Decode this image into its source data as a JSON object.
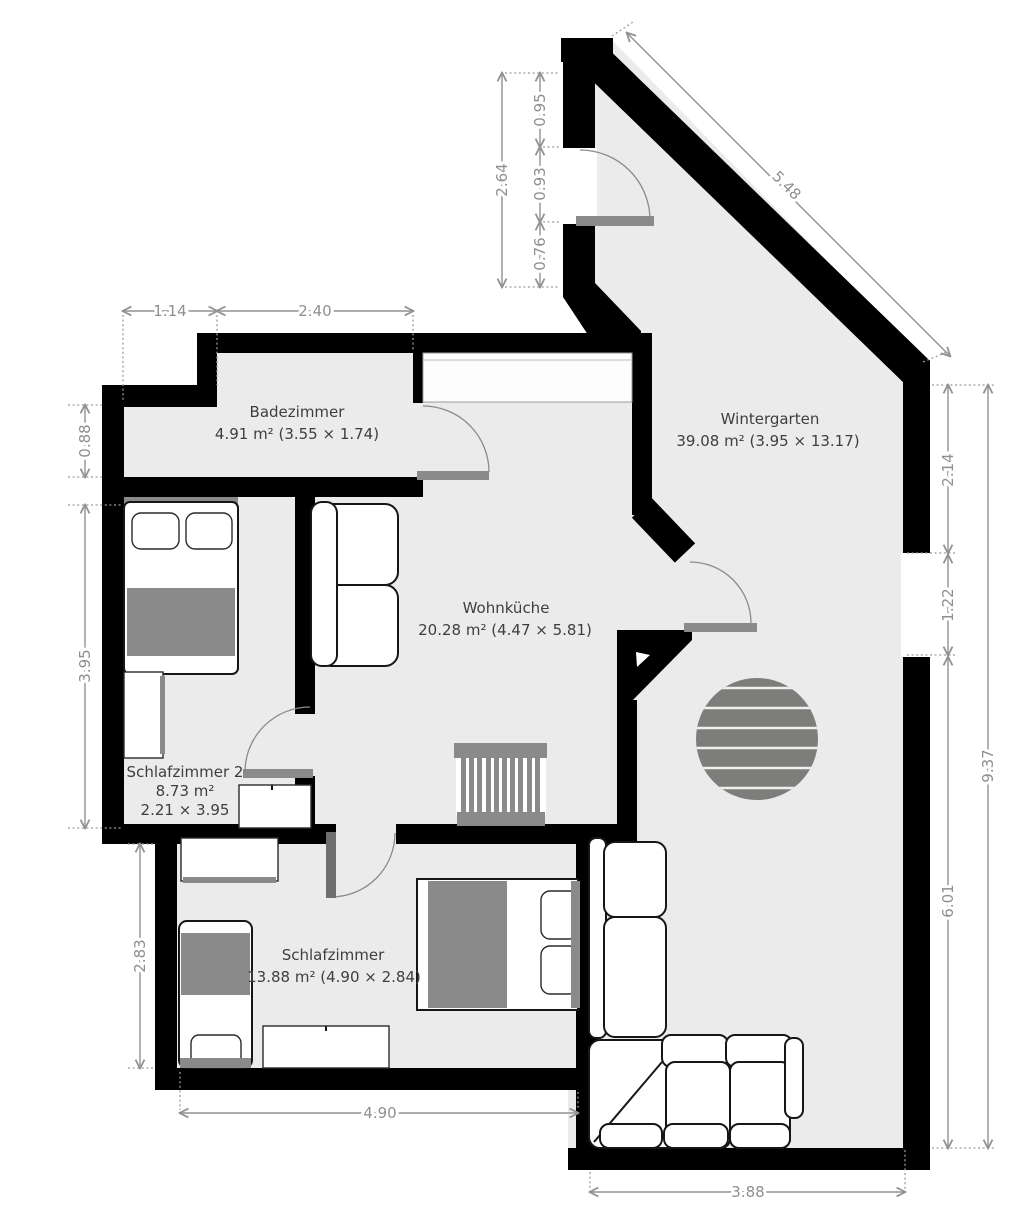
{
  "floorplan": {
    "rooms": [
      {
        "id": "badezimmer",
        "name": "Badezimmer",
        "area": "4.91 m² (3.55 × 1.74)"
      },
      {
        "id": "wintergarten",
        "name": "Wintergarten",
        "area": "39.08 m² (3.95 × 13.17)"
      },
      {
        "id": "wohnkueche",
        "name": "Wohnküche",
        "area": "20.28 m² (4.47 × 5.81)"
      },
      {
        "id": "schlafzimmer2",
        "name": "Schlafzimmer 2",
        "area": "8.73 m²",
        "dims": "2.21 × 3.95"
      },
      {
        "id": "schlafzimmer",
        "name": "Schlafzimmer",
        "area": "13.88 m² (4.90 × 2.84)"
      }
    ],
    "dimensions": {
      "bath_top_left": "1.14",
      "bath_top_right": "2.40",
      "bath_height": "0.88",
      "wg_wall_total": "2.64",
      "wg_wall_seg_top": "0.95",
      "wg_wall_door": "0.93",
      "wg_wall_seg_bottom": "0.76",
      "wg_diagonal": "5.48",
      "sz2_height": "3.95",
      "sz_height": "2.83",
      "sz_width": "4.90",
      "right_top": "2.14",
      "right_window": "1.22",
      "right_bottom": "6.01",
      "right_total": "9.37",
      "wg_bottom": "3.88"
    },
    "colors": {
      "wall": "#000000",
      "floor": "#ebebeb",
      "outside": "#ffffff",
      "furniture_accent": "#8a8a8a",
      "door_leaf": "#8a8a8a",
      "door_leaf_dark": "#6e6e6e",
      "dimension_text": "#8f8f8f",
      "label_text": "#3e3e3e"
    }
  }
}
